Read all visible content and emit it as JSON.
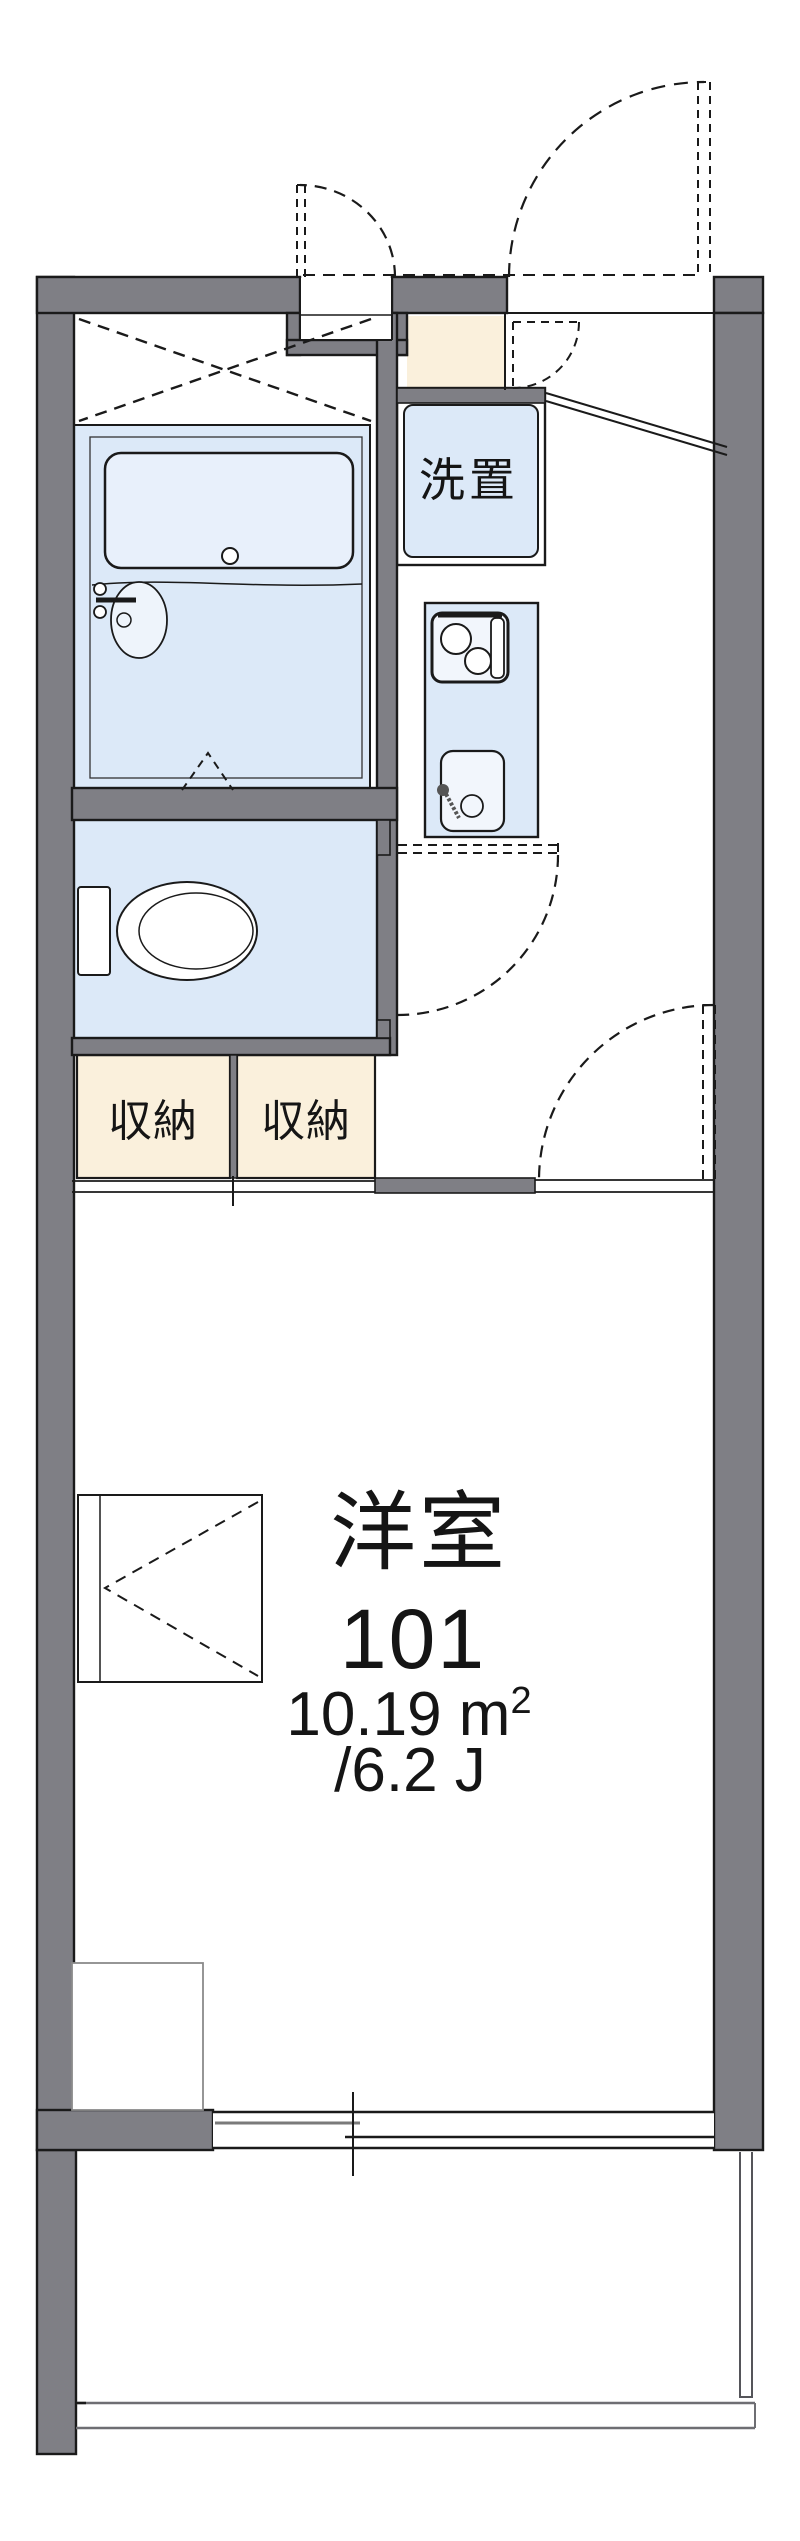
{
  "floorplan": {
    "room_label": "洋室",
    "room_number": "101",
    "area_sqm_main": "10.19 m",
    "area_sqm_sup": "2",
    "area_tatami": "/6.2 J",
    "washer_label": "洗置",
    "storage_label_1": "収納",
    "storage_label_2": "収納"
  },
  "colors": {
    "background": "#ffffff",
    "wall": "#7f7f85",
    "outline": "#1a1a1a",
    "water_fixture": "#dce9f8",
    "bathtub": "#e8f0fb",
    "fixture_light": "#f2f6fc",
    "storage_fill": "#faf0dc"
  }
}
